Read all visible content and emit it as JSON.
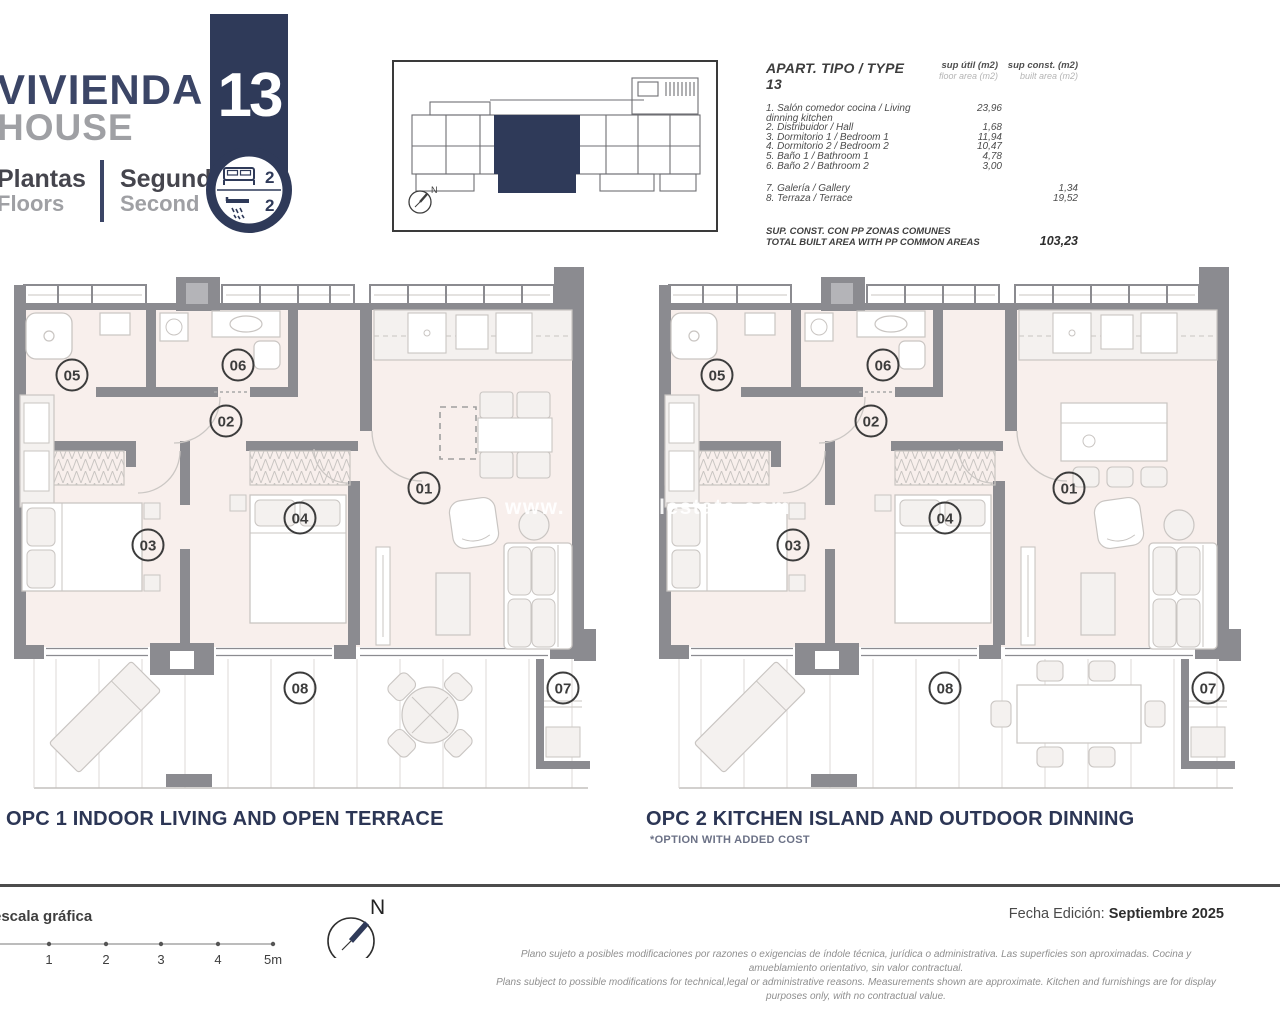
{
  "header": {
    "title_es": "VIVIENDA",
    "title_en": "HOUSE",
    "floors_label_es": "Plantas",
    "floors_label_en": "Floors",
    "floor_value_es": "Segunda",
    "floor_value_en": "Second",
    "unit_number": "13",
    "bedrooms": "2",
    "bathrooms": "2"
  },
  "area_table": {
    "title": "APART. TIPO / TYPE 13",
    "col1_label": "sup útil (m2)",
    "col1_sublabel": "floor area (m2)",
    "col2_label": "sup const. (m2)",
    "col2_sublabel": "built area (m2)",
    "rows": [
      {
        "label": "1. Salón comedor cocina / Living dinning kitchen",
        "floor": "23,96",
        "built": "",
        "gap_after": false
      },
      {
        "label": "2. Distribuidor / Hall",
        "floor": "1,68",
        "built": "",
        "gap_after": false
      },
      {
        "label": "3. Dormitorio 1 / Bedroom 1",
        "floor": "11,94",
        "built": "",
        "gap_after": false
      },
      {
        "label": "4. Dormitorio 2 / Bedroom 2",
        "floor": "10,47",
        "built": "",
        "gap_after": false
      },
      {
        "label": "5. Baño 1 / Bathroom 1",
        "floor": "4,78",
        "built": "",
        "gap_after": false
      },
      {
        "label": "6. Baño 2 / Bathroom 2",
        "floor": "3,00",
        "built": "",
        "gap_after": true
      },
      {
        "label": "7. Galería / Gallery",
        "floor": "",
        "built": "1,34",
        "gap_after": false
      },
      {
        "label": "8. Terraza / Terrace",
        "floor": "",
        "built": "19,52",
        "gap_after": false
      }
    ],
    "total_label_es": "SUP. CONST. CON PP ZONAS COMUNES",
    "total_label_en": "TOTAL BUILT AREA WITH PP COMMON AREAS",
    "total_value": "103,23"
  },
  "plans": {
    "room_labels": [
      "01",
      "02",
      "03",
      "04",
      "05",
      "06",
      "07",
      "08"
    ],
    "opc1_caption": "OPC 1 INDOOR LIVING AND OPEN TERRACE",
    "opc2_caption": "OPC 2 KITCHEN ISLAND AND OUTDOOR DINNING",
    "opc2_note": "*OPTION WITH ADDED COST",
    "watermark_prefix": "www.",
    "watermark_suffix": "realestate.com"
  },
  "footer": {
    "scale_label": "escala gráfica",
    "scale_ticks": [
      "1",
      "2",
      "3",
      "4",
      "5m"
    ],
    "north_label": "N",
    "edition_label": "Fecha Edición:",
    "edition_value": "Septiembre 2025",
    "disclaimer_es": "Plano sujeto a posibles modificaciones por razones o exigencias de índole técnica,  jurídica o administrativa. Las superficies son aproximadas. Cocina y amueblamiento orientativo, sin valor contractual.",
    "disclaimer_en": "Plans subject to possible modifications for technical,legal or administrative reasons. Measurements shown are approximate. Kitchen and furnishings are for display purposes only, with no contractual value."
  },
  "colors": {
    "navy": "#2f3a59",
    "wall_gray": "#8b8b90",
    "floor_fill": "#f8efec",
    "furniture_line": "#c9c5c2"
  }
}
